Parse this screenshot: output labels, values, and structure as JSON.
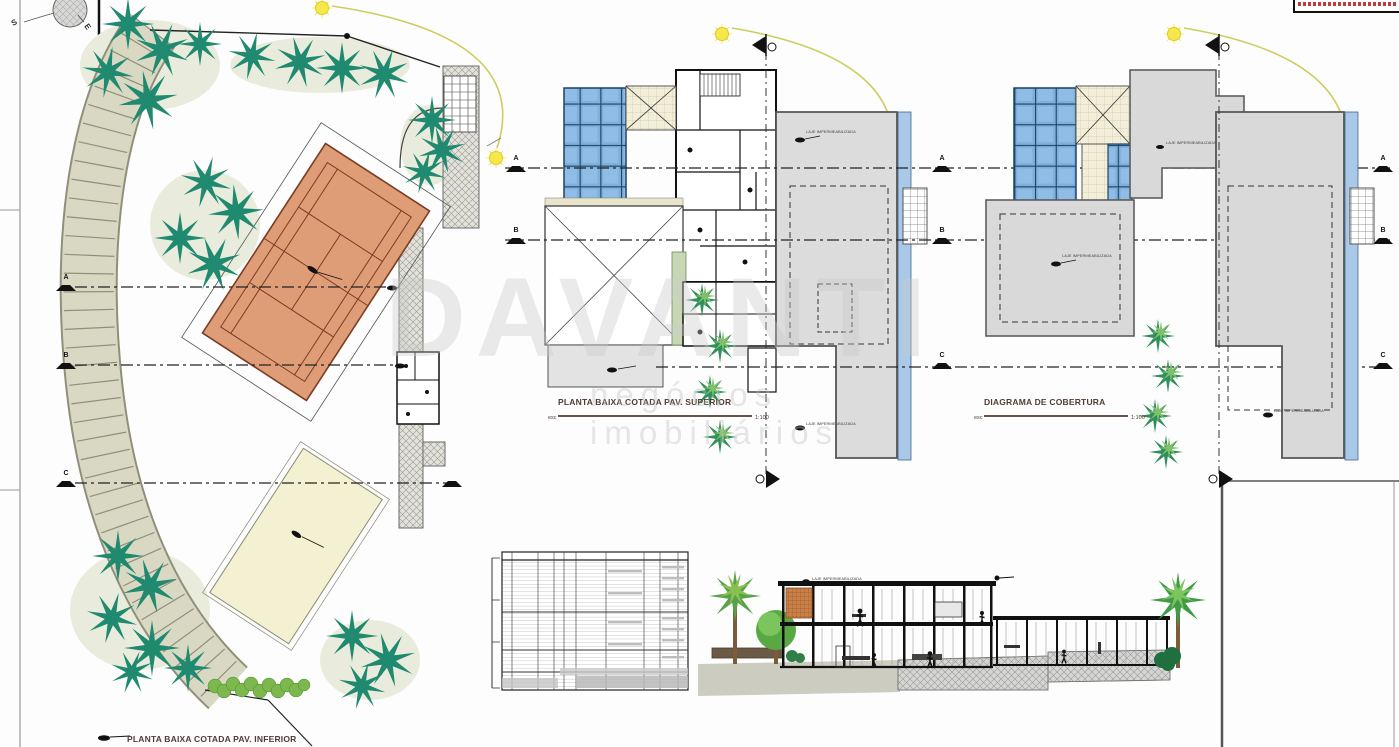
{
  "watermark": {
    "brand": "DAVANTI",
    "tagline": "negócios imobiliários"
  },
  "compass": {
    "south": "S",
    "east": "E"
  },
  "grid": {
    "a": "A",
    "b": "B",
    "c": "C"
  },
  "plans": {
    "site": {
      "title": "PLANTA BAIXA COTADA PAV. INFERIOR"
    },
    "upper": {
      "title": "PLANTA BAIXA COTADA PAV. SUPERIOR",
      "scale_prefix": "esc",
      "scale": "1:100"
    },
    "roof": {
      "title": "DIAGRAMA DE COBERTURA",
      "scale_prefix": "esc",
      "scale": "1:100"
    }
  },
  "annotations": {
    "slab_note": "LAJE IMPERMEABILIZADA"
  },
  "colors": {
    "tree_green": "#1f8a70",
    "court_clay": "#df9d77",
    "glass_blue": "#7fb0dc",
    "roof_gray": "#dcdcdc",
    "sun_yellow": "#f2e23a",
    "path_beige": "#d9d9c3",
    "title_brown": "#503c34",
    "stamp_red": "#c23a3a"
  }
}
